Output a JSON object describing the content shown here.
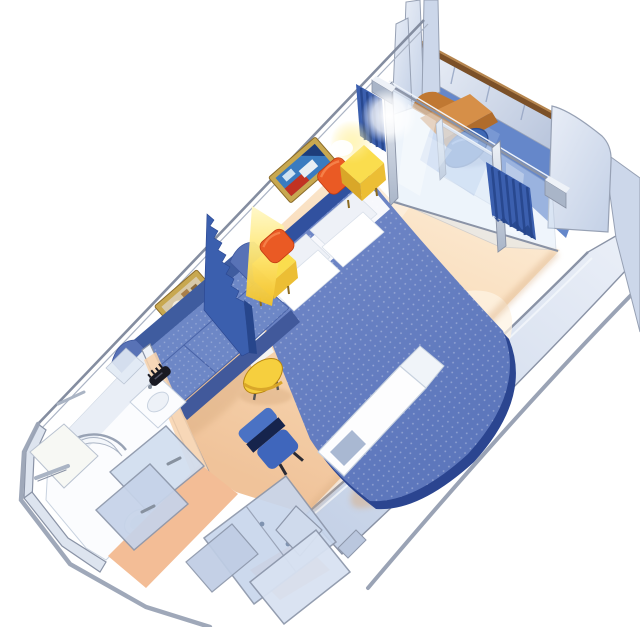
{
  "canvas": {
    "width": 640,
    "height": 627,
    "background": "#ffffff",
    "label": "balcony-stateroom-floorplan"
  },
  "elements": [
    "balcony",
    "balcony-lounge-chair",
    "balcony-table",
    "balcony-railing",
    "balcony-divider-panels",
    "sliding-glass-doors",
    "pleated-curtains",
    "bed",
    "pillows",
    "accent-cushions",
    "nightstands",
    "wall-art",
    "sofa",
    "coffee-table",
    "desk",
    "desk-chair",
    "room-divider-curtain",
    "bathroom",
    "shower",
    "sink",
    "toilet",
    "wardrobe-doors",
    "entry-door"
  ],
  "colors": {
    "background": "#ffffff",
    "wallEdge": "#8a93a6",
    "wallEdgeLight": "#aab3c3",
    "panelLight": "#e9eef7",
    "panelMid": "#c3d0e6",
    "panelShade": "#aebcd6",
    "sidePanel": "#ccd7ea",
    "bulwarkCap": "#7b5028",
    "bulwarkCapHi": "#b5854e",
    "balconyFloor": "#6587ca",
    "balconyFloorHi": "#8ba5da",
    "glass": "#dceaf9",
    "glassEdge": "#9fb0c8",
    "metalHi": "#eef2f8",
    "metalLo": "#a9b5c8",
    "curtain": "#3b5fae",
    "curtainDark": "#27468c",
    "floorHi": "#fdeeda",
    "floorMid": "#f8d9b4",
    "floorLo": "#f0c39a",
    "entryFloor": "#f3bd96",
    "rug": "#fdf3e3",
    "floorShadow": "#d9ad82",
    "bedTop": "#5d77bc",
    "bedTopHi": "#7289c8",
    "bedRim": "#2b4590",
    "headboard": "#31519f",
    "pillow": "#ffffff",
    "pillowShade": "#eef1f7",
    "sheet": "#fdfdfe",
    "orange": "#ea5a24",
    "orangeHi": "#f58048",
    "yellowTop": "#fadd4e",
    "yellowSide": "#ecbe34",
    "yellowDark": "#d9a728",
    "lampGlow": "#ffe878",
    "lampGlowDeep": "#f5c42a",
    "sofaBack": "#3f5c9f",
    "sofaCushion": "#6d87c6",
    "sofaArm": "#5872b6",
    "sofaFront": "#41599b",
    "tableTop": "#f6cf3e",
    "tableEdge": "#d9a62a",
    "chairBlue": "#4a72c4",
    "chairSeat": "#3f66bc",
    "chairDark": "#16244c",
    "desk": "#fdfdfe",
    "deskShelf": "#a9b8d2",
    "gold": "#c8a850",
    "goldDark": "#8a6b2a",
    "artBlue": "#3a7bc0",
    "artRed": "#c23222",
    "artTan": "#d8c9a8",
    "artFigure": "#a87f4a",
    "artNavy": "#1d3d7a",
    "fixtureWhite": "#fbfcfe",
    "fixtureEdge": "#c9d3e0",
    "chrome": "#aab4c4",
    "chromeDark": "#87919f",
    "loungeTan": "#d68f48",
    "loungeTanDark": "#b06c2c",
    "loungeBack": "#c07832",
    "balconyTableBlue": "#3e68b4",
    "balconyTableEdge": "#2b4d94",
    "dark": "#191922",
    "white": "#ffffff"
  }
}
